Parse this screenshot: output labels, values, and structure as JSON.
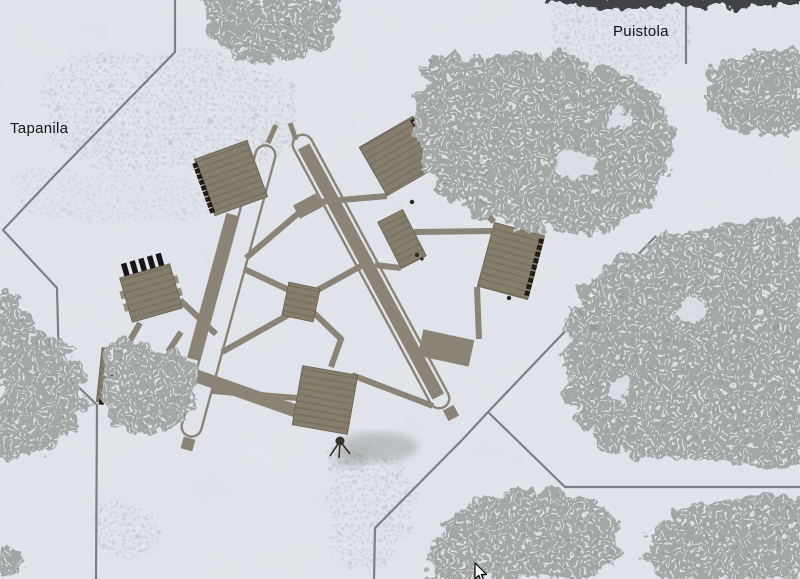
{
  "map": {
    "place_labels": [
      {
        "id": "puistola",
        "text": "Puistola"
      },
      {
        "id": "tapanila",
        "text": "Tapanila"
      }
    ],
    "symbols": [
      {
        "name": "aa-gun-marker"
      },
      {
        "name": "poi-dot"
      },
      {
        "name": "mouse-cursor"
      }
    ]
  },
  "colors": {
    "snow": "#dee3ea",
    "forest": "#a3a7a6",
    "forest-dash": "#e7ebed",
    "forest-dark": "#3f4244",
    "village": "#b4b9bf",
    "road": "#7b8084",
    "runway": "#8b8476",
    "building": "#867e6d",
    "building-stripe": "#78705f",
    "building-edge": "#685f4f",
    "window": "#241c11",
    "chimney": "#161616",
    "marker": "#33322c",
    "smudge": "#63635c",
    "label": "#141414"
  }
}
